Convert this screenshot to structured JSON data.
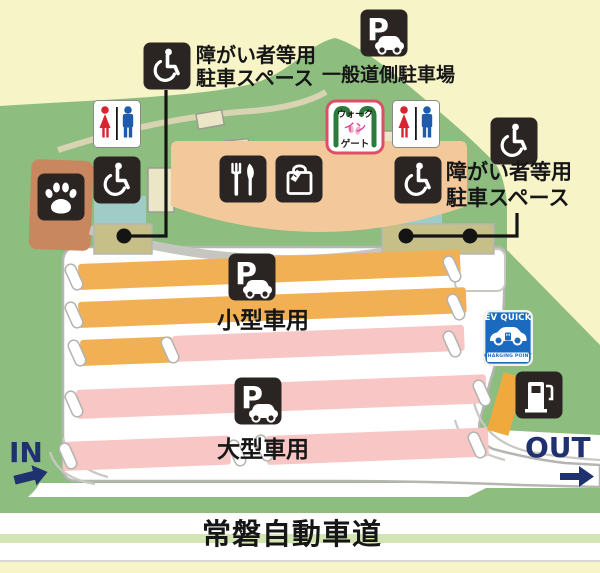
{
  "labels": {
    "disabled_parking": {
      "line1": "障がい者等用",
      "line2": "駐車スペース"
    },
    "general_parking": "一般道側駐車場",
    "small_car": "小型車用",
    "large_car": "大型車用",
    "expressway": "常磐自動車道",
    "in": "IN",
    "out": "OUT"
  },
  "walk_gate": {
    "line1": "ウォーク",
    "line2": "イン",
    "line3": "ゲート"
  },
  "ev_sign": {
    "title": "EV QUICK",
    "subtitle": "CHARGING POINT"
  },
  "parking_icon_letter": "P",
  "colors": {
    "background": "#f7f4c8",
    "hill_green": "#8dbd7f",
    "lane_line_green": "#d2e5b2",
    "road_white": "#ffffff",
    "road_outline_gray": "#b5b5b2",
    "stripe_orange_small_car": "#f2b054",
    "stripe_pink_large_car": "#f8c6c4",
    "building_peach": "#f3c89b",
    "facility_teal": "#9fccc6",
    "parking_pad_olive": "#c6bf87",
    "dog_run_brown": "#c8875f",
    "icon_box_dark": "#2a2523",
    "in_out_navy": "#20316f",
    "gate_green": "#2e7a3a",
    "gate_border_red": "#dd4f66",
    "gate_pink": "#e0488e",
    "ev_blue": "#1a6bbf",
    "restroom_female_red": "#d8242f",
    "restroom_male_blue": "#1f5bad"
  }
}
